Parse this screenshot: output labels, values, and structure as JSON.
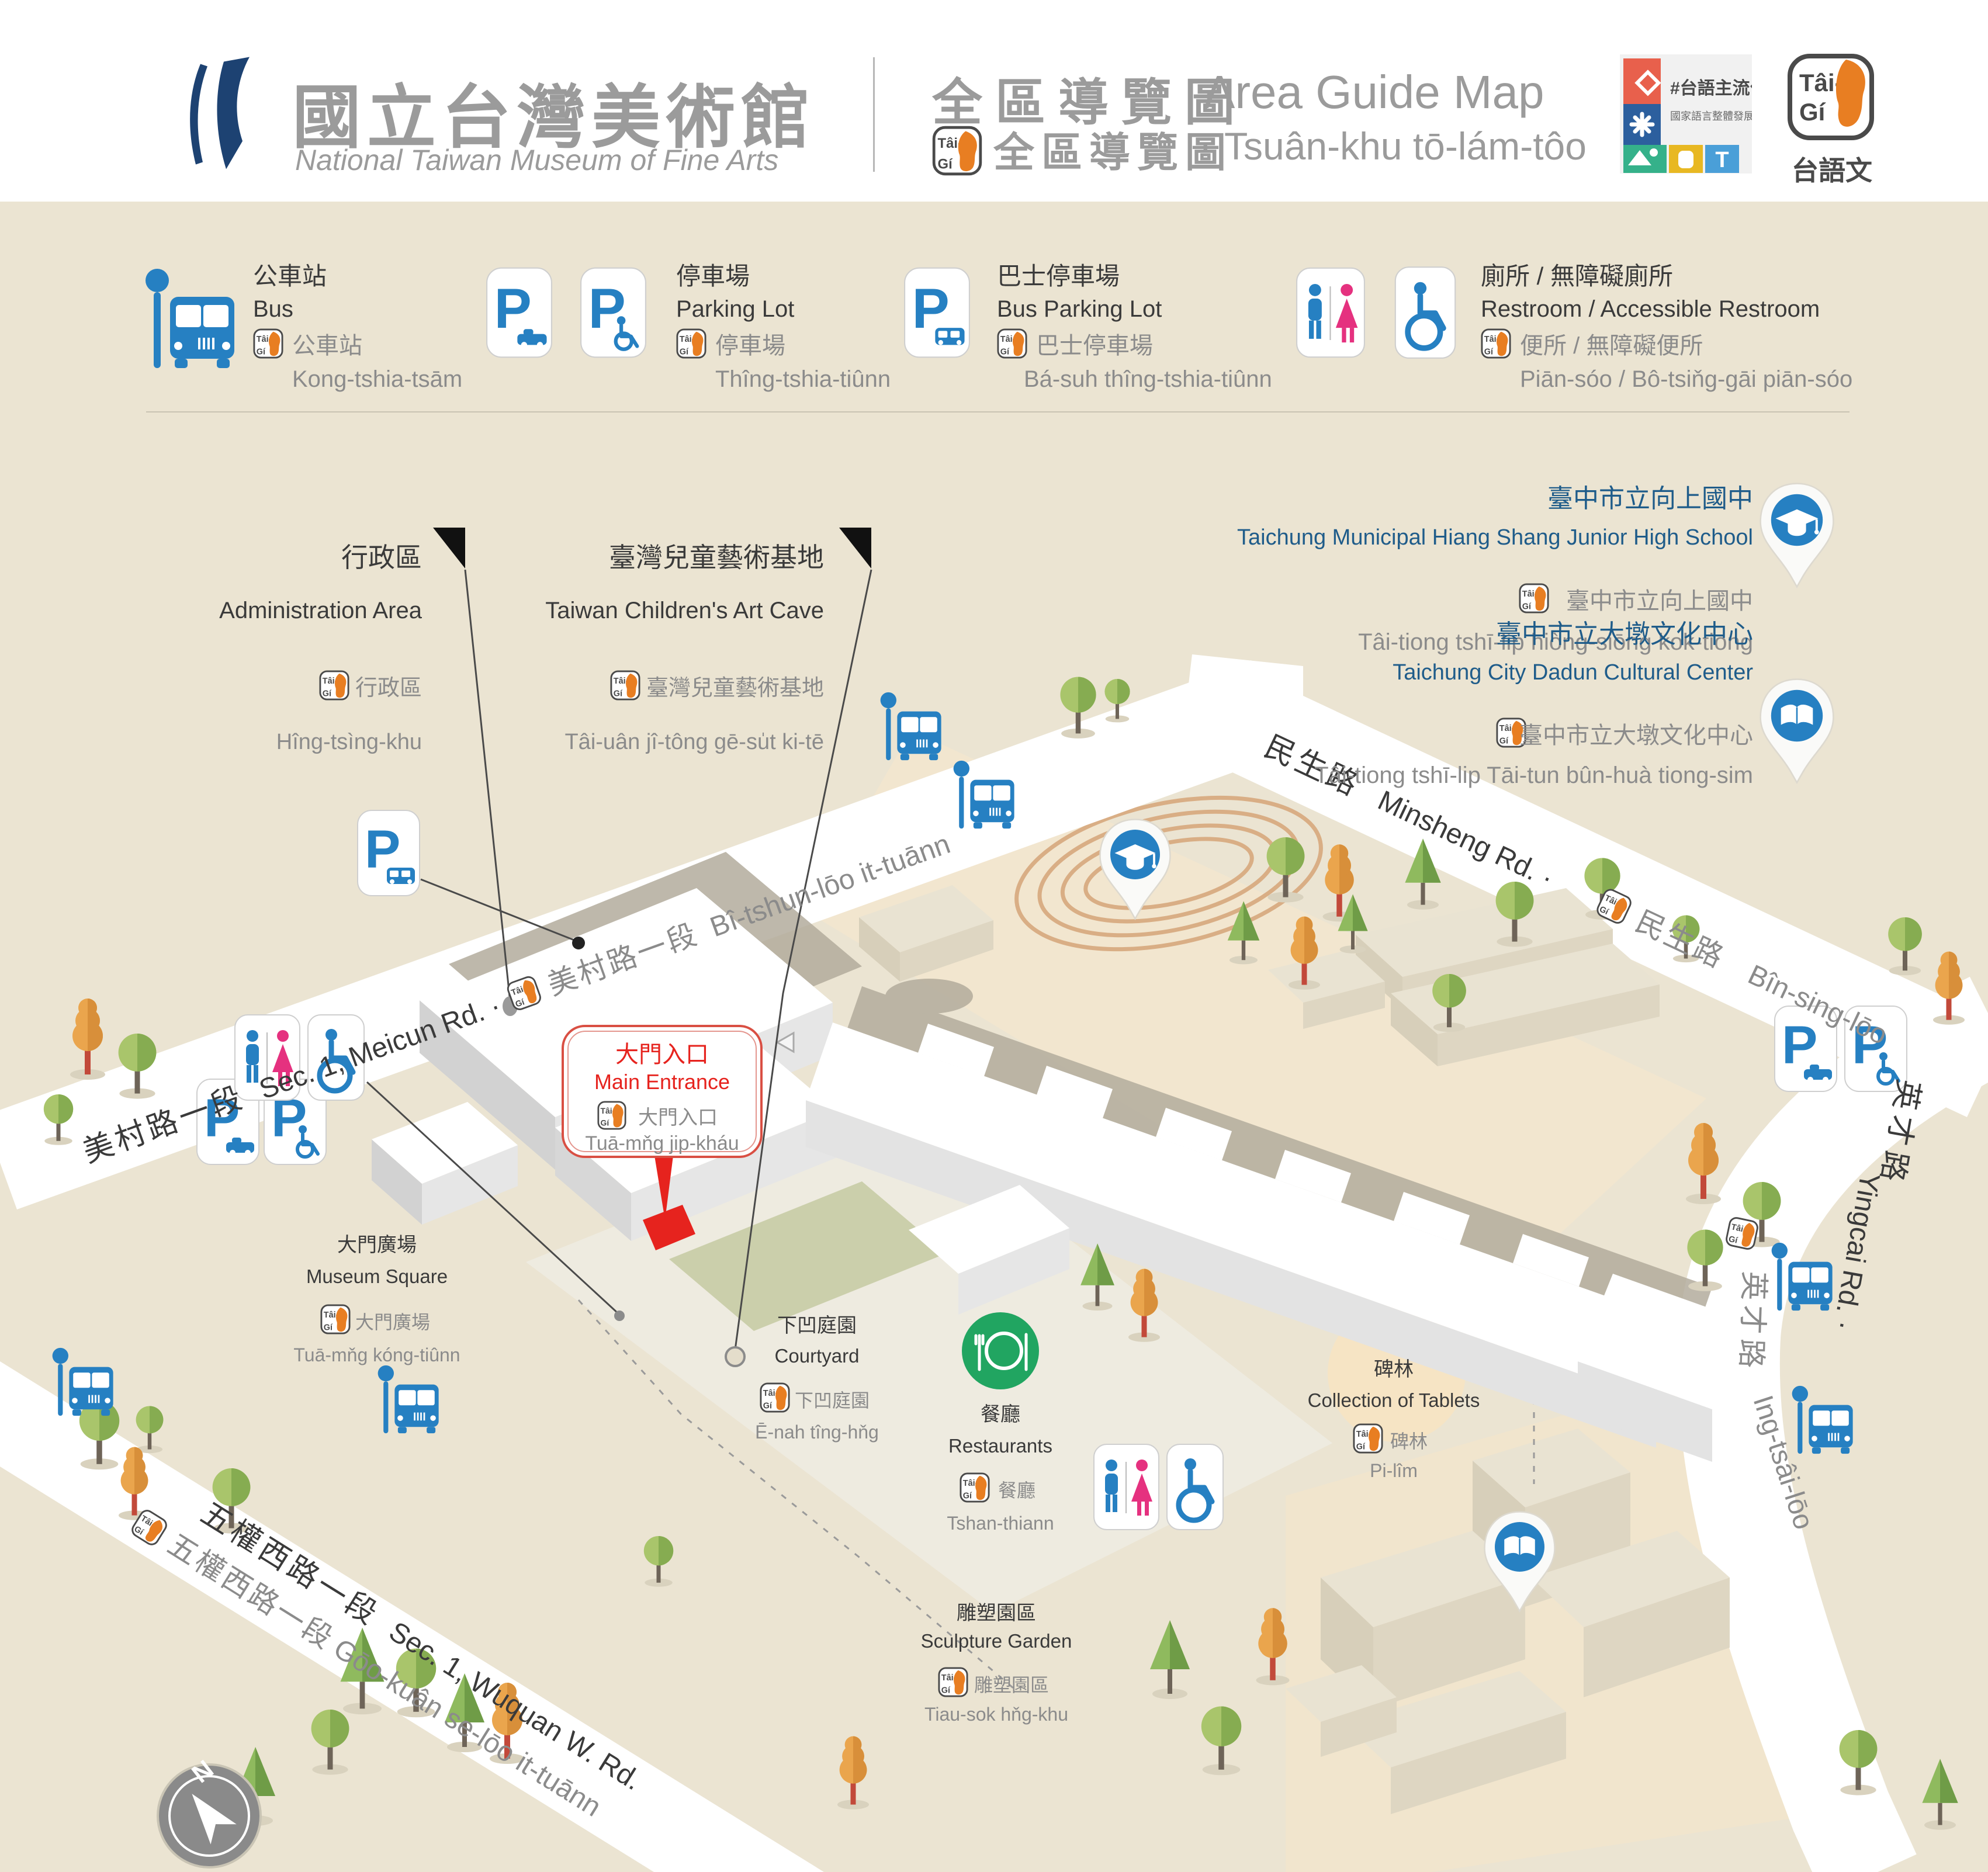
{
  "header": {
    "museum_cjk": "國立台灣美術館",
    "museum_en": "National Taiwan Museum of Fine Arts",
    "title_cjk": "全區導覽圖",
    "title_en": "Area Guide Map",
    "subtitle_cjk": "全區導覽圖",
    "subtitle_rom": "Tsuân-khu tō-lám-tôo",
    "badge_campaign": {
      "line1": "#台語主流化",
      "line2": "國家語言整體發展方案",
      "tile_t": "T"
    },
    "badge_taigi_caption": "台語文"
  },
  "taigi": {
    "l1": "Tâi-",
    "l2": "Gí"
  },
  "icons": {
    "p": "P"
  },
  "compass": {
    "n": "N"
  },
  "legend": {
    "bus": {
      "cjk": "公車站",
      "en": "Bus",
      "cjk2": "公車站",
      "rom": "Kong-tshia-tsām"
    },
    "parking": {
      "cjk": "停車場",
      "en": "Parking Lot",
      "cjk2": "停車場",
      "rom": "Thîng-tshia-tiûnn"
    },
    "bus_parking": {
      "cjk": "巴士停車場",
      "en": "Bus Parking Lot",
      "cjk2": "巴士停車場",
      "rom": "Bá-suh  thîng-tshia-tiûnn"
    },
    "restroom": {
      "cjk": "廁所 / 無障礙廁所",
      "en": "Restroom / Accessible Restroom",
      "cjk2": "便所 / 無障礙便所",
      "rom": "Piān-sóo / Bô-tsiňg-gāi piān-sóo"
    }
  },
  "roads": {
    "meicun": {
      "cjk": "美村路一段",
      "en": "Sec. 1, Meicun Rd. ·",
      "cjk2": "美村路一段",
      "rom": "Bî-tshun-lōo it-tuānn"
    },
    "minsheng": {
      "cjk": "民生路",
      "en": "Minsheng Rd. ·",
      "cjk2": "民生路",
      "rom": "Bîn-sing-lōo"
    },
    "yucai": {
      "cjk": "英才路",
      "en": "Yingcai Rd. ·",
      "cjk2": "英才路",
      "rom": "Ing-tsâi-lōo"
    },
    "wuquan": {
      "cjk": "五權西路一段",
      "en": "Sec. 1, Wuquan W. Rd.",
      "cjk2": "五權西路一段",
      "rom": "Gōo-kuân se-lōo it-tuānn"
    }
  },
  "places": {
    "admin": {
      "cjk": "行政區",
      "en": "Administration Area",
      "cjk2": "行政區",
      "rom": "Hîng-tsìng-khu"
    },
    "artcave": {
      "cjk": "臺灣兒童藝術基地",
      "en": "Taiwan Children's Art Cave",
      "cjk2": "臺灣兒童藝術基地",
      "rom": "Tâi-uân jî-tông gē-su̍t ki-tē"
    },
    "entrance": {
      "cjk": "大門入口",
      "en": "Main Entrance",
      "cjk2": "大門入口",
      "rom": "Tuā-mňg jip-kháu"
    },
    "square": {
      "cjk": "大門廣場",
      "en": "Museum Square",
      "cjk2": "大門廣場",
      "rom": "Tuā-mňg kóng-tiûnn"
    },
    "courtyard": {
      "cjk": "下凹庭園",
      "en": "Courtyard",
      "cjk2": "下凹庭園",
      "rom": "Ē-nah tîng-hňg"
    },
    "restaurants": {
      "cjk": "餐廳",
      "en": "Restaurants",
      "cjk2": "餐廳",
      "rom": "Tshan-thiann"
    },
    "tablets": {
      "cjk": "碑林",
      "en": "Collection of Tablets",
      "cjk2": "碑林",
      "rom": "Pi-lîm"
    },
    "sculpture": {
      "cjk": "雕塑園區",
      "en": "Sculpture Garden",
      "cjk2": "雕塑園區",
      "rom": "Tiau-sok hňg-khu"
    },
    "school": {
      "cjk": "臺中市立向上國中",
      "en": "Taichung Municipal Hiang Shang Junior High School",
      "cjk2": "臺中市立向上國中",
      "rom": "Tâi-tiong tshī-lip hiòng-siōng kok-tiong"
    },
    "dadun": {
      "cjk": "臺中市立大墩文化中心",
      "en": "Taichung City Dadun Cultural Center",
      "cjk2": "臺中市立大墩文化中心",
      "rom": "Tâi-tiong tshī-lip Tāi-tun bûn-huà tiong-sim"
    }
  },
  "colors": {
    "bg": "#ebe4d2",
    "road": "#ffffff",
    "accent_blue": "#2680c2",
    "pink": "#e5317f",
    "red": "#e6231e",
    "green": "#21a561",
    "poi_blue": "#1f5c8a",
    "text_dark": "#3a3a3a",
    "text_gray": "#8b8b8b",
    "building_top": "#ffffff",
    "shadow": "#b3ac9c",
    "navy_logo": "#1d4272"
  }
}
